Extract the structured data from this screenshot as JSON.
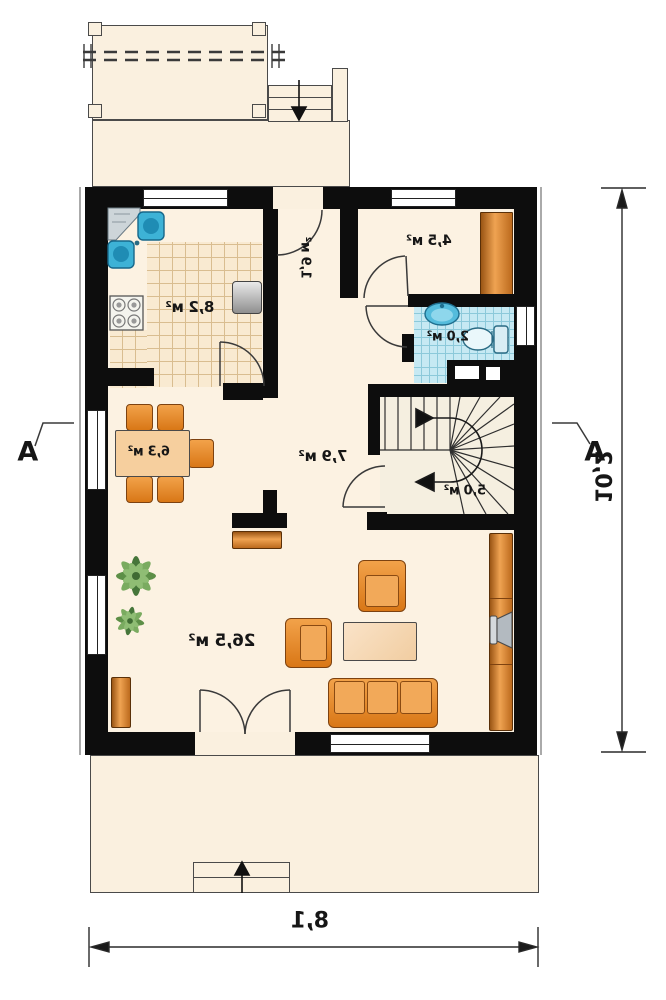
{
  "rooms": {
    "kitchen": {
      "label": "8,2 м²"
    },
    "vestibule": {
      "label": "1,9 м²"
    },
    "storage": {
      "label": "4,5 м²"
    },
    "bathroom": {
      "label": "2,0 м²"
    },
    "dining": {
      "label": "6,3 м²"
    },
    "hall": {
      "label": "7,9 м²"
    },
    "stairs": {
      "label": "5,0 м²"
    },
    "living": {
      "label": "26,5 м²"
    }
  },
  "dimensions": {
    "width": "8,1",
    "height": "10,2"
  },
  "section": {
    "left": "A",
    "right": "A"
  },
  "colors": {
    "wall": "#0d0d0d",
    "floor": "#fcf2e2",
    "terrace": "#faf0df",
    "furniture": "#ec8c2e",
    "tile_blue": "#c6e9f3",
    "water": "#3fb0d6",
    "line": "#333333"
  }
}
